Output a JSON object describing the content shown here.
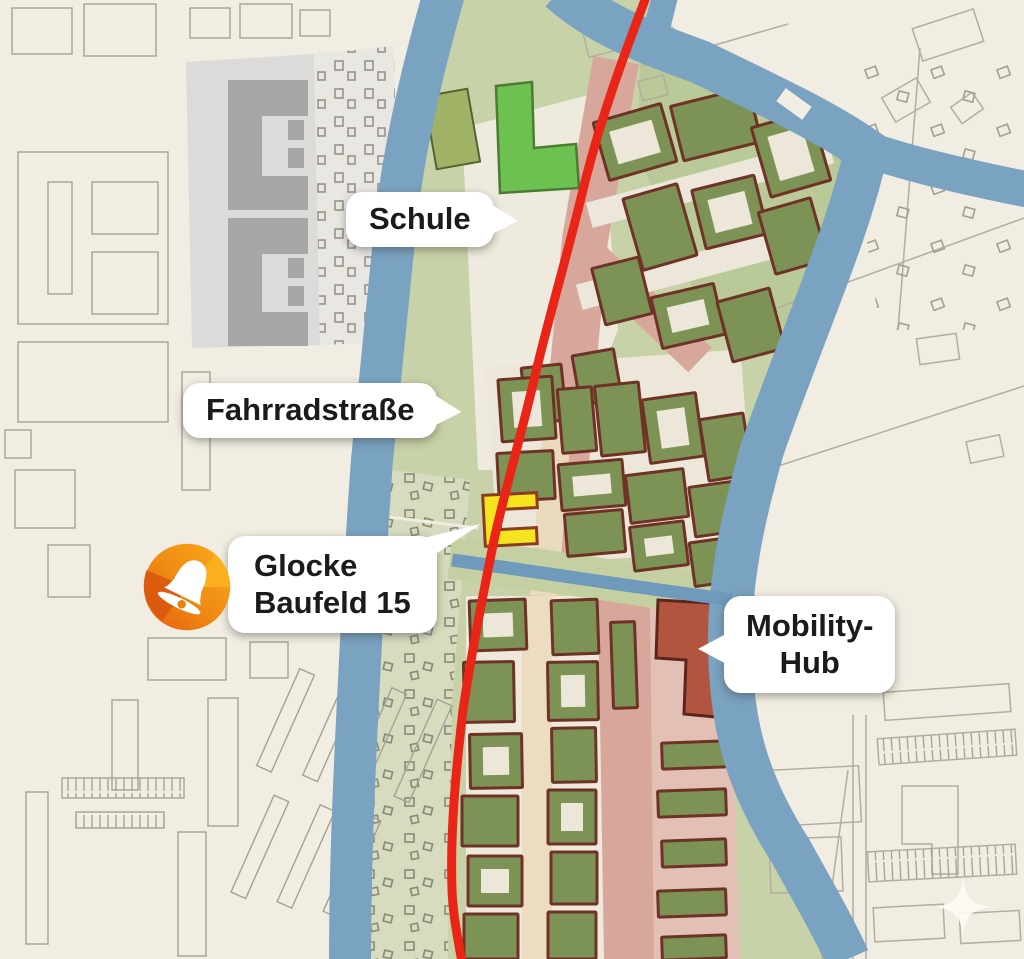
{
  "map": {
    "labels": {
      "schule": "Schule",
      "fahrradstrasse": "Fahrradstraße",
      "glocke_line1": "Glocke",
      "glocke_line2": "Baufeld 15",
      "mobility_line1": "Mobility-",
      "mobility_line2": "Hub"
    },
    "marker": {
      "icon": "bell-icon",
      "color": "#f08c13"
    },
    "colors": {
      "accent_red_route": "#e92517",
      "water_blue": "#7aa2c1",
      "park_green": "#c8d2a8",
      "building_olive": "#7d9356",
      "building_outline": "#6e3226",
      "street_pink": "#d8a79c",
      "street_beige": "#ecdcc0",
      "mobility_red": "#b15440",
      "baufeld_yellow": "#f6e41f",
      "school_green": "#6cc151",
      "background_cream": "#f1ede2"
    }
  }
}
